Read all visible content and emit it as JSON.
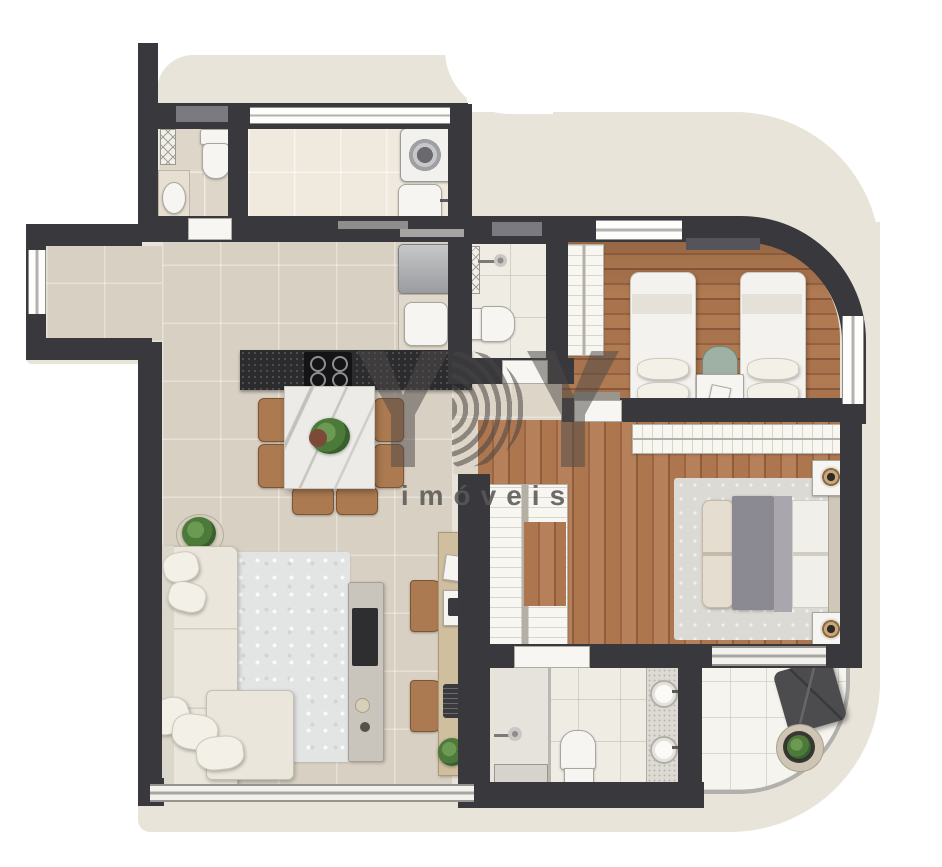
{
  "watermark": {
    "letters": [
      "Y",
      "B",
      "Y"
    ],
    "subtitle": "imóveis"
  },
  "palette": {
    "wall": "#39383c",
    "facade": "#e9e4da",
    "floor_hall": "#d8d0c2",
    "floor_service": "#f0eade",
    "floor_bath": "#efece4",
    "floor_terrace": "#f6f4ee",
    "wood_bedroom": "#a8734d",
    "wood_master": "#ad764f",
    "rug_living": "#e2e5e4",
    "rug_master": "#dbdad5",
    "counter_granite": "#2c2c2f",
    "marble_table": "#ecebe7",
    "sofa": "#eae6dc",
    "chair_brown": "#ab7a50",
    "chair_green": "#9fb0a5",
    "glass": "#b2b0ac",
    "plant_green": "#4c7a3a",
    "beanbag": "#4c4c4f",
    "watermark_gray": "rgba(78,74,72,0.52)"
  },
  "rooms": [
    "powder-room",
    "service-laundry",
    "kitchen",
    "dining-area",
    "living-room",
    "hallway",
    "social-bathroom",
    "bedroom-2",
    "master-closet",
    "master-bedroom",
    "master-bathroom",
    "terrace"
  ],
  "furniture": [
    "toilet",
    "washbasin",
    "washing-machine",
    "laundry-sink",
    "refrigerator",
    "kitchen-sink",
    "cooktop",
    "dining-table",
    "dining-chair",
    "centerpiece-plant",
    "sofa",
    "rug",
    "tv-console",
    "tv",
    "desk",
    "desk-chair",
    "potted-plant",
    "shower",
    "single-bed",
    "nightstand",
    "wardrobe",
    "double-bed",
    "bedside-lamp",
    "double-vanity",
    "shower-bench",
    "beanbag",
    "round-planter"
  ]
}
